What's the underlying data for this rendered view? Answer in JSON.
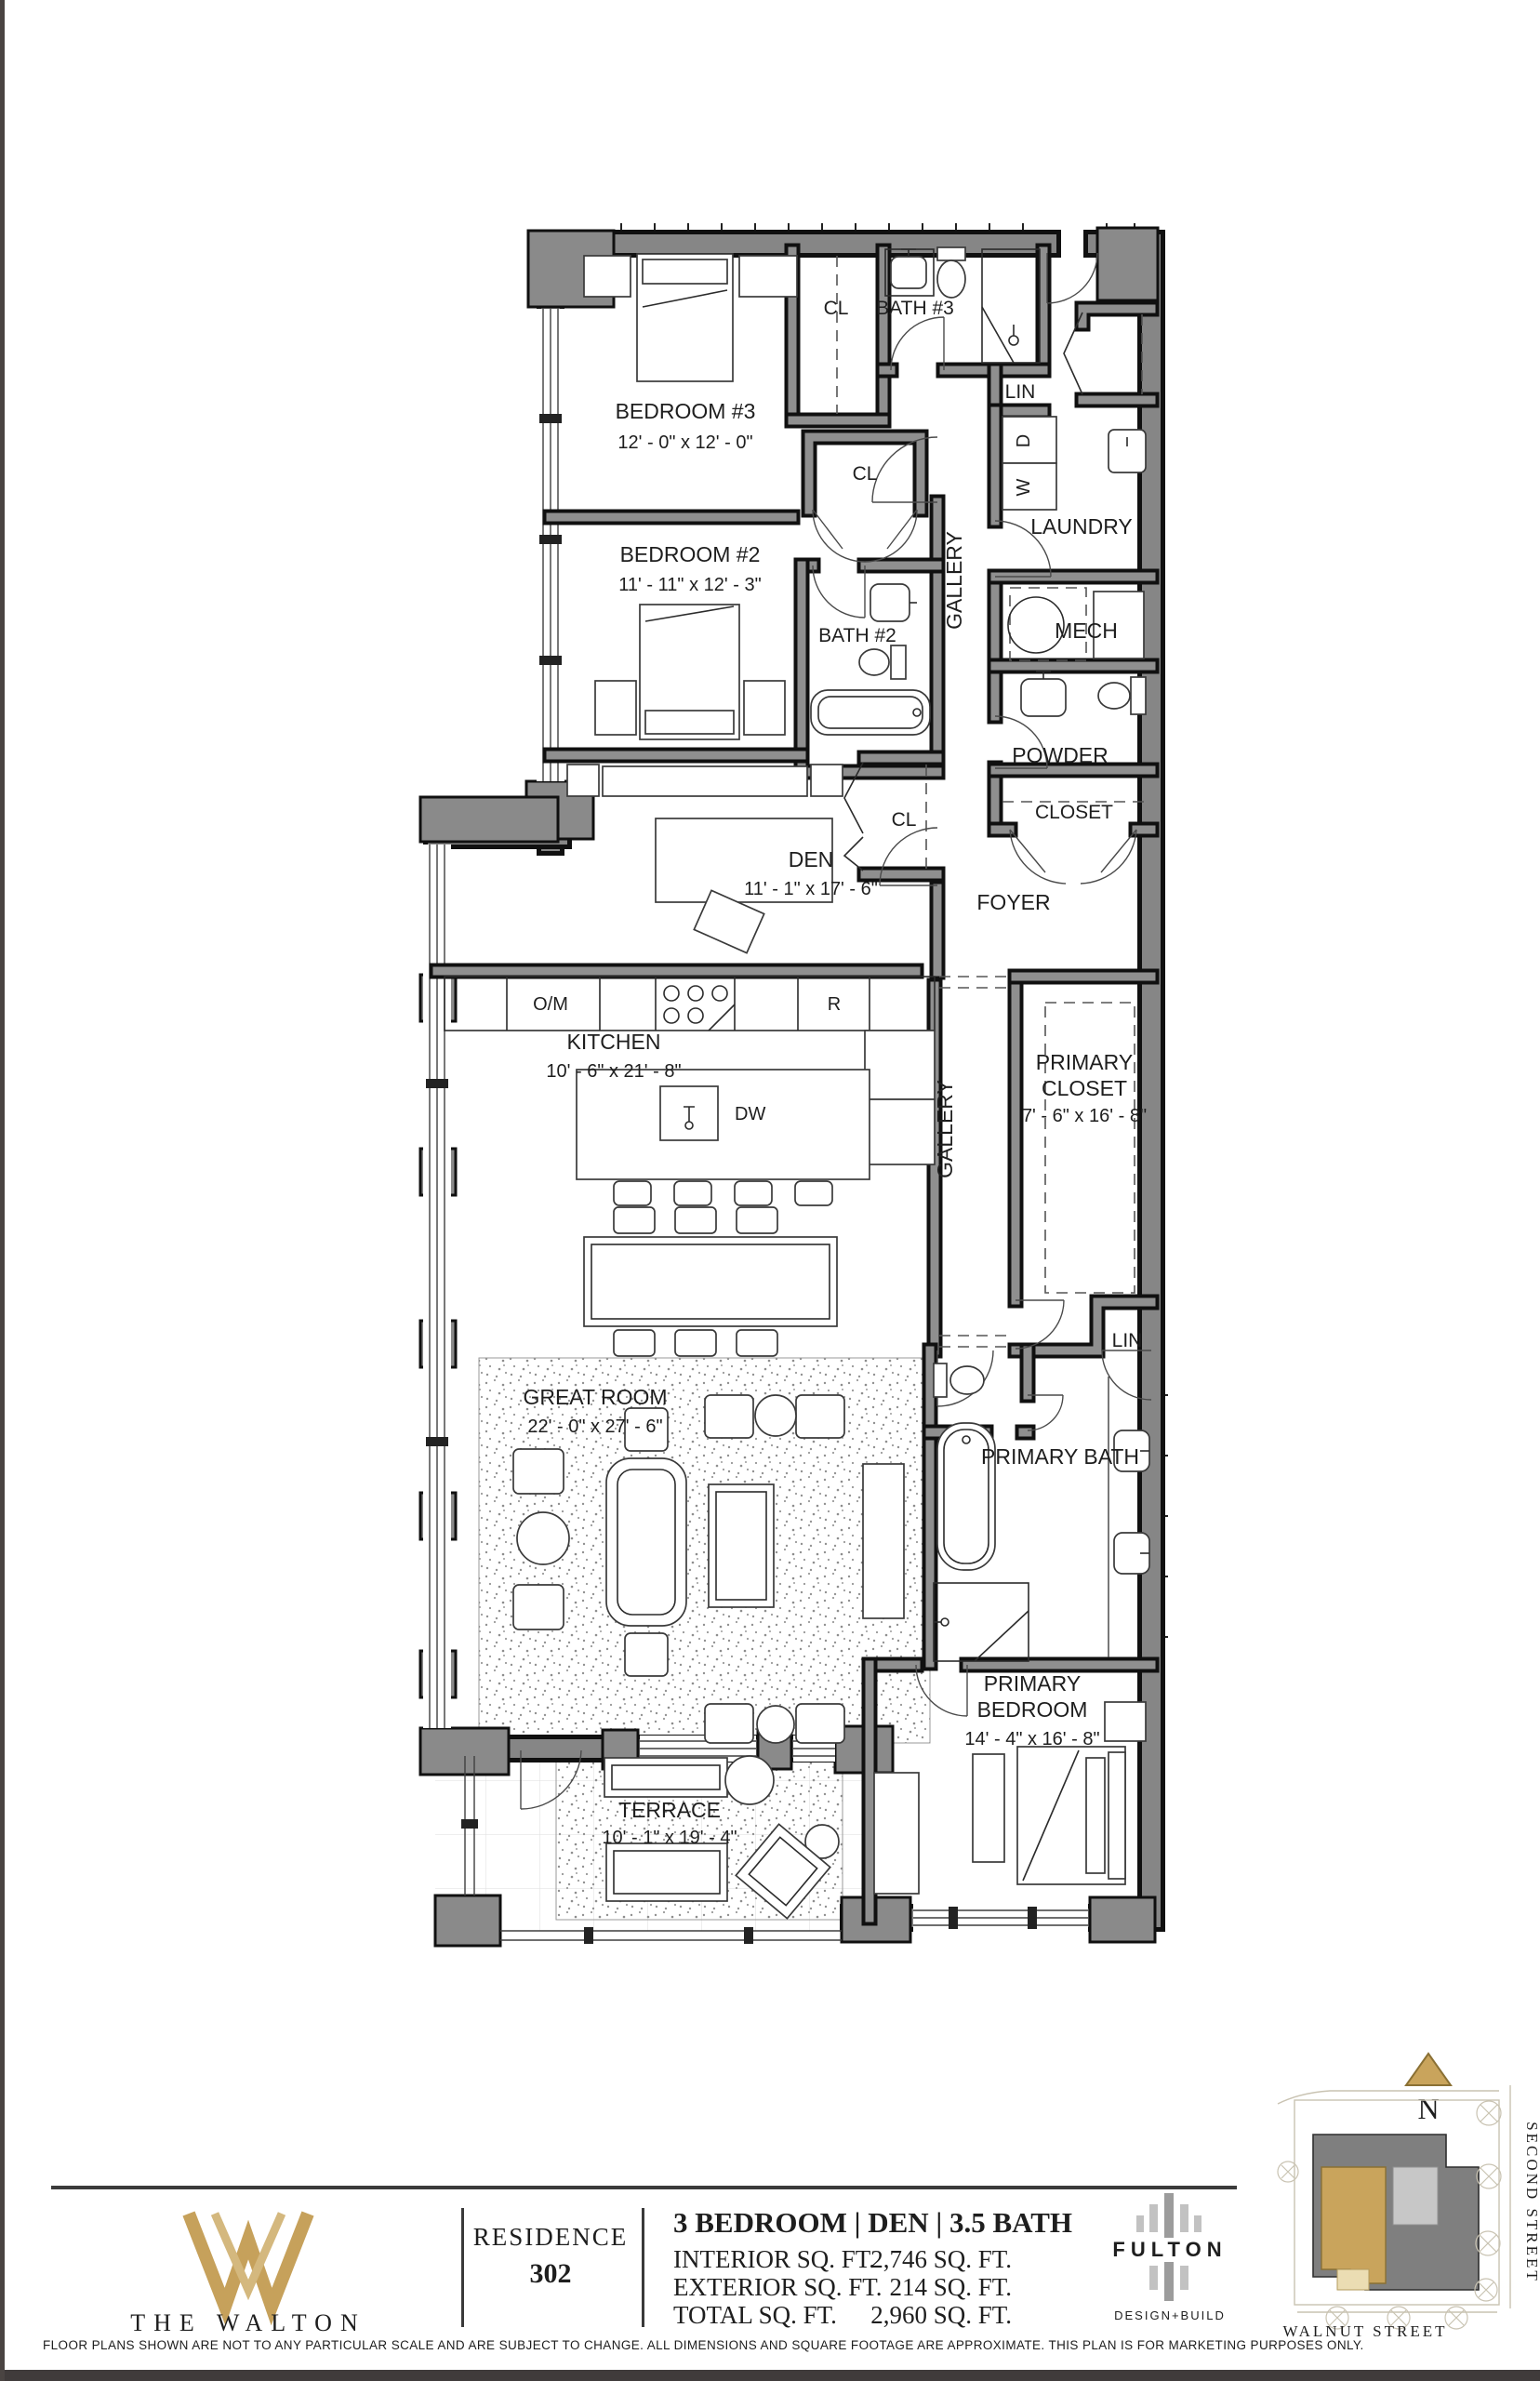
{
  "plan": {
    "labels": {
      "bedroom3": {
        "name": "BEDROOM #3",
        "dim": "12' - 0\" x 12' - 0\""
      },
      "bedroom2": {
        "name": "BEDROOM #2",
        "dim": "11' - 11\" x 12' - 3\""
      },
      "bath3": "BATH #3",
      "bath2": "BATH #2",
      "den": {
        "name": "DEN",
        "dim": "11' - 1\" x 17' - 6\""
      },
      "kitchen": {
        "name": "KITCHEN",
        "dim": "10' - 6\" x 21' - 8\""
      },
      "great_room": {
        "name": "GREAT ROOM",
        "dim": "22' - 0\" x 27' - 6\""
      },
      "primary_closet": {
        "line1": "PRIMARY",
        "line2": "CLOSET",
        "dim": "7' - 6\" x 16' - 8\""
      },
      "primary_bath": "PRIMARY BATH",
      "primary_bedroom": {
        "line1": "PRIMARY",
        "line2": "BEDROOM",
        "dim": "14' - 4\" x 16' - 8\""
      },
      "terrace": {
        "name": "TERRACE",
        "dim": "10' - 1\" x 19' - 4\""
      },
      "laundry": "LAUNDRY",
      "mech": "MECH",
      "powder": "POWDER",
      "closet": "CLOSET",
      "foyer": "FOYER",
      "gallery": "GALLERY",
      "cl": "CL",
      "lin": "LIN",
      "oven": "O/M",
      "range": "R",
      "dishwasher": "DW",
      "washer": "W",
      "dryer": "D"
    }
  },
  "footer": {
    "brand": "THE WALTON",
    "residence_label": "RESIDENCE",
    "residence_number": "302",
    "unit_type": "3 BEDROOM | DEN | 3.5 BATH",
    "stats": [
      {
        "label": "INTERIOR SQ. FT.",
        "value": "2,746 SQ. FT."
      },
      {
        "label": "EXTERIOR SQ. FT.",
        "value": "214 SQ. FT."
      },
      {
        "label": "TOTAL SQ. FT.",
        "value": "2,960 SQ. FT."
      }
    ],
    "builder": {
      "name": "FULTON",
      "tagline": "DESIGN+BUILD"
    },
    "accent_color": "#C6A15B"
  },
  "sitemap": {
    "north": "N",
    "street_right": "SECOND STREET",
    "street_bottom": "WALNUT STREET",
    "unit_color": "#C9A45C"
  },
  "disclaimer": "FLOOR PLANS SHOWN ARE NOT TO ANY PARTICULAR SCALE AND ARE SUBJECT TO CHANGE. ALL DIMENSIONS AND SQUARE FOOTAGE ARE APPROXIMATE. THIS PLAN IS FOR MARKETING PURPOSES ONLY."
}
